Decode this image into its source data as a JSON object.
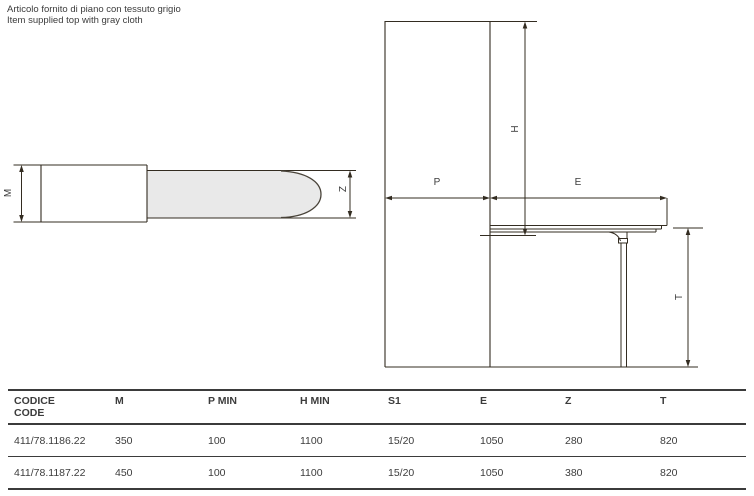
{
  "note": {
    "line1": "NOTE",
    "line2": "Articolo fornito di piano con tessuto grigio",
    "line3": "Item supplied top with gray cloth"
  },
  "labels": {
    "m": "M",
    "z": "Z",
    "p": "P",
    "e": "E",
    "h": "H",
    "t": "T"
  },
  "colors": {
    "line": "#332c21",
    "top_fill": "#e9e9e9",
    "text": "#3b3b3b"
  },
  "table": {
    "columns": [
      {
        "line1": "CODICE",
        "line2": "CODE"
      },
      {
        "line1": "M"
      },
      {
        "line1": "P MIN"
      },
      {
        "line1": "H MIN"
      },
      {
        "line1": "S1"
      },
      {
        "line1": "E"
      },
      {
        "line1": "Z"
      },
      {
        "line1": "T"
      }
    ],
    "rows": [
      {
        "cells": [
          "411/78.1186.22",
          "350",
          "100",
          "1100",
          "15/20",
          "1050",
          "280",
          "820"
        ]
      },
      {
        "cells": [
          "411/78.1187.22",
          "450",
          "100",
          "1100",
          "15/20",
          "1050",
          "380",
          "820"
        ]
      }
    ]
  }
}
